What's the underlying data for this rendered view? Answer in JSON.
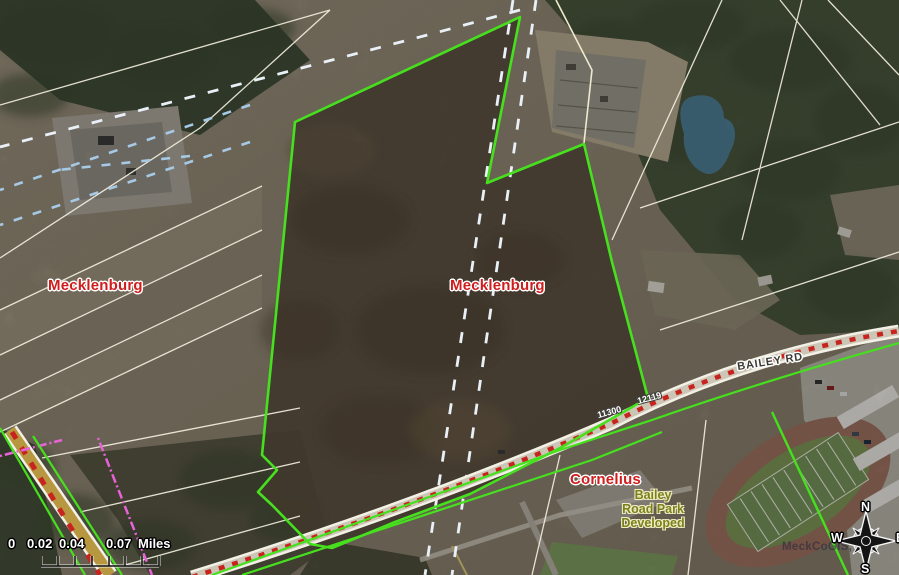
{
  "map": {
    "labels": {
      "county_west": "Mecklenburg",
      "county_east": "Mecklenburg",
      "city": "Cornelius",
      "park": "Bailey\nRoad Park\nDeveloped",
      "road": "BAILEY RD",
      "parcel_address_west": "11300",
      "parcel_address_east": "12119"
    },
    "scale_bar": {
      "ticks": [
        "0",
        "0.02",
        "0.04",
        "0.07"
      ],
      "unit": "Miles"
    },
    "compass": {
      "north": "N",
      "south": "S",
      "east": "E",
      "west": "W"
    },
    "watermark": "MeckCoGIS, me",
    "colors": {
      "parcel_boundary_green": "#46e01e",
      "road_marker_red": "#c8241f",
      "county_label_red": "#cf1d1d",
      "park_label_olive": "#77821c",
      "boundary_dash_white": "#e9f0f7",
      "easement_dash_blue": "#a6c9e6",
      "utility_dash_pink": "#e862d8",
      "parcel_line_white": "#f2eedd",
      "pond_blue": "#4c7b92",
      "road_fill_tan": "#b7973f"
    }
  }
}
